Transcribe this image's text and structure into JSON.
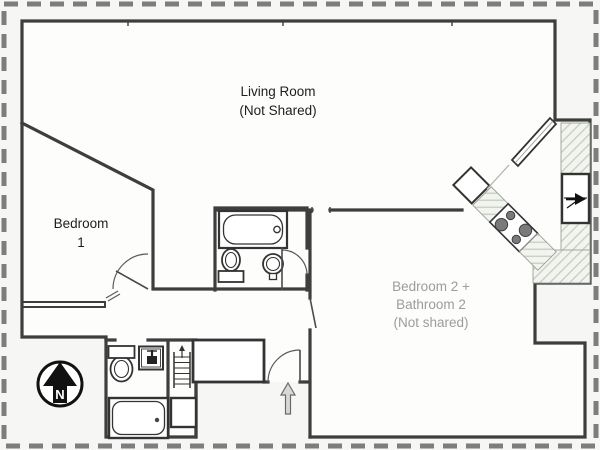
{
  "plan": {
    "labels": {
      "living_room": [
        "Living Room",
        "(Not Shared)"
      ],
      "bedroom1": [
        "Bedroom",
        "1"
      ],
      "bedroom2": [
        "Bedroom 2 +",
        "Bathroom 2",
        "(Not shared)"
      ],
      "compass": "N"
    },
    "colors": {
      "background": "#f6f6f4",
      "room_fill": "#fdfdfc",
      "wall": "#3e3e3e",
      "dashed_border": "#7d7d7d",
      "hatch_line": "#c5ccc0",
      "hatch_fill": "#f2f4ef",
      "fixture_line": "#333333",
      "label_dark": "#1e1e1e",
      "label_gray": "#9c9c9c",
      "entry_arrow_fill": "#d9d9d4",
      "burner_fill": "#7a7a7a"
    },
    "fixtures": {
      "bathroom_top": [
        "bathtub",
        "toilet",
        "pedestal-sink",
        "door-arc"
      ],
      "bathroom_bottom": [
        "toilet",
        "sink",
        "bathtub"
      ],
      "kitchen": [
        "cabinet-bar",
        "sink-unit",
        "stove-4-burners",
        "hatched-counter",
        "refrigerator"
      ],
      "hall": [
        "closet",
        "stairs-ladder",
        "shaft-closet",
        "entry-door",
        "entry-arrow"
      ],
      "compass": [
        "north-arrow"
      ]
    }
  }
}
